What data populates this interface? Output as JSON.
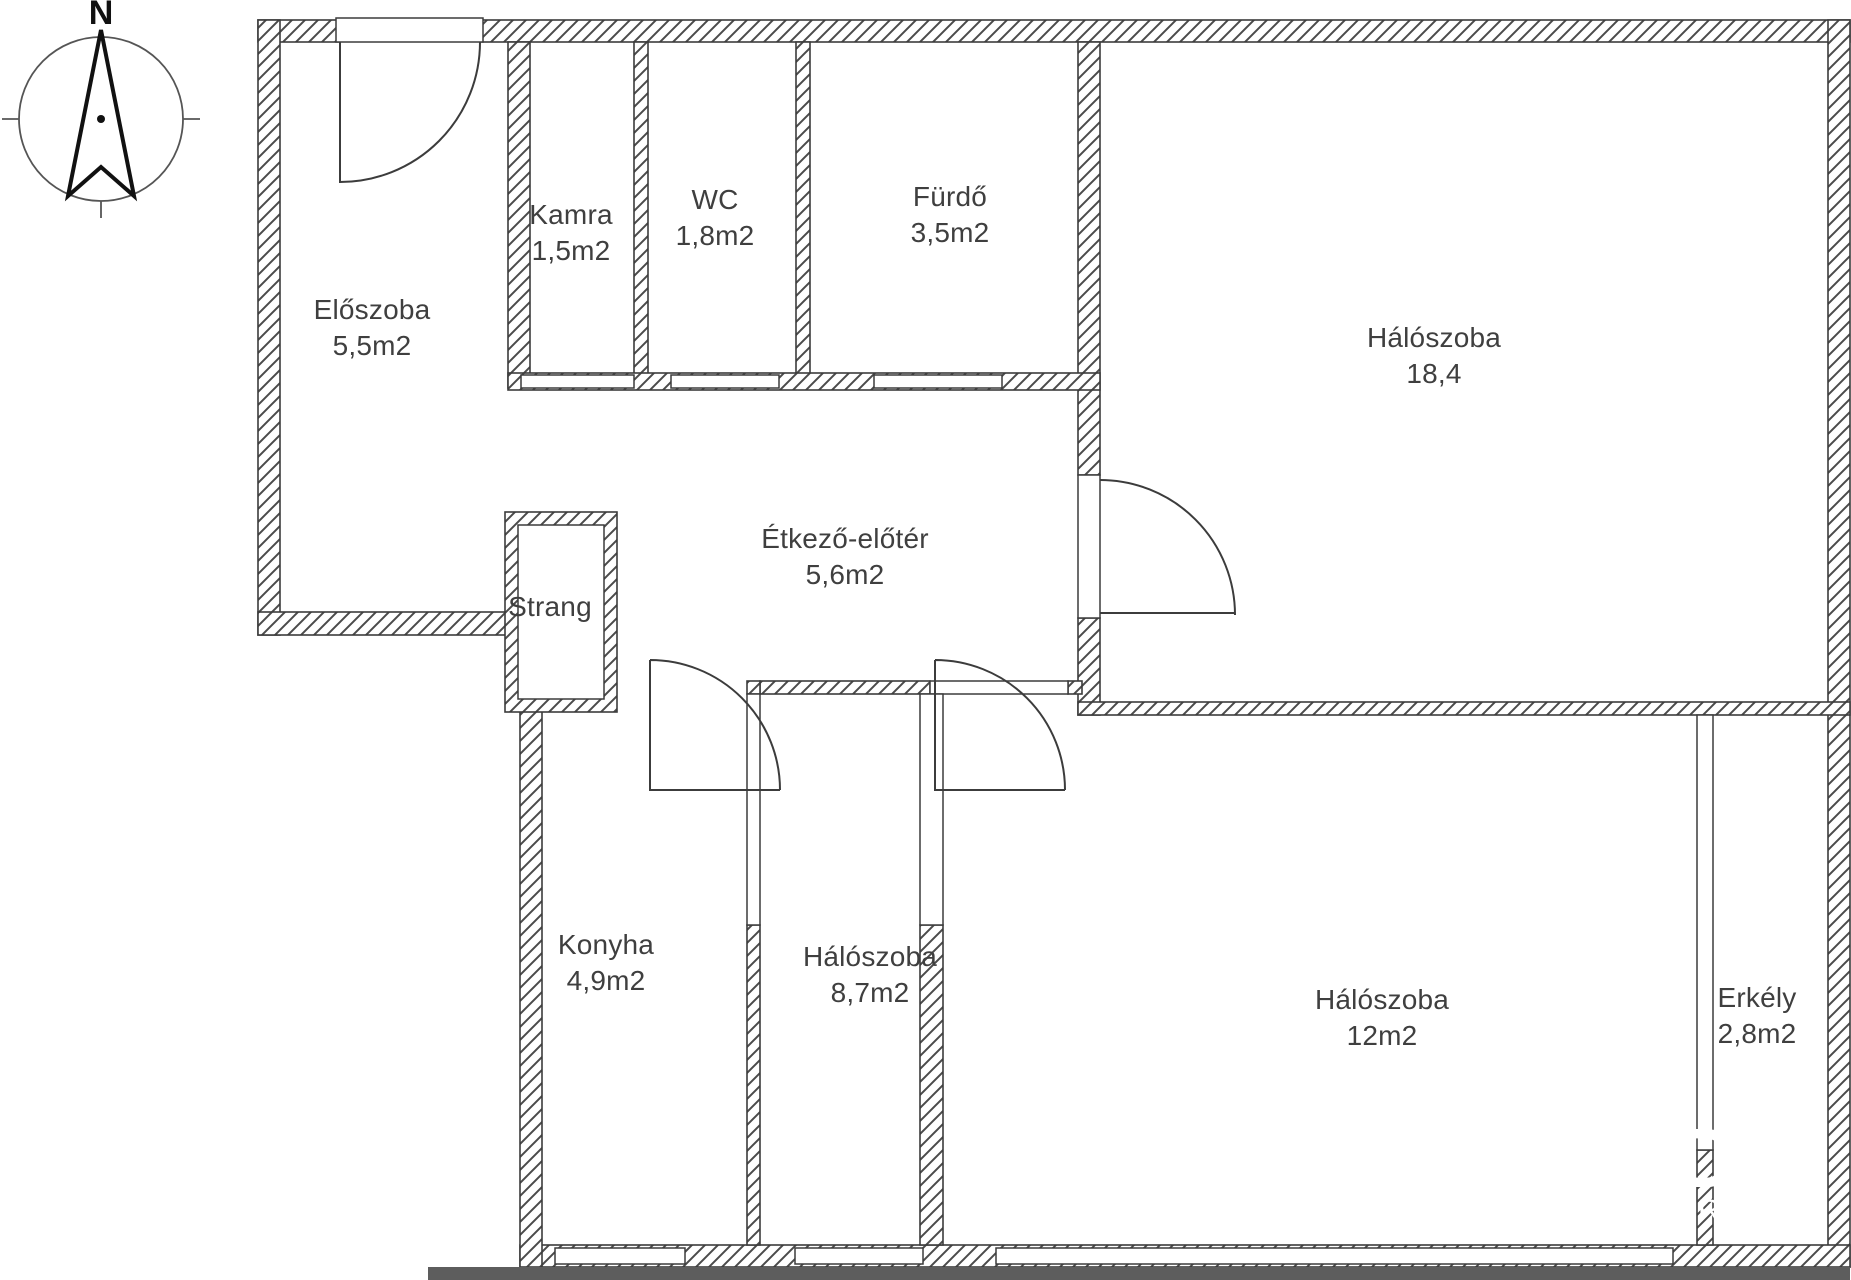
{
  "title": "Apartment floor plan",
  "compass": {
    "north_label": "N"
  },
  "rooms": [
    {
      "name": "Előszoba",
      "area": "5,5m2"
    },
    {
      "name": "Kamra",
      "area": "1,5m2"
    },
    {
      "name": "WC",
      "area": "1,8m2"
    },
    {
      "name": "Fürdő",
      "area": "3,5m2"
    },
    {
      "name": "Hálószoba",
      "area": "18,4"
    },
    {
      "name": "Étkező-előtér",
      "area": "5,6m2"
    },
    {
      "name": "Strang",
      "area": ""
    },
    {
      "name": "Konyha",
      "area": "4,9m2"
    },
    {
      "name": "Hálószoba",
      "area": "8,7m2"
    },
    {
      "name": "Hálószoba",
      "area": "12m2"
    },
    {
      "name": "Erkély",
      "area": "2,8m2"
    }
  ],
  "watermark": {
    "letter_large": "D",
    "letter_small": "R"
  },
  "colors": {
    "wall_line": "#3c3c3c",
    "hatch_line": "#4b4b4b",
    "label_text": "#3f3f3f",
    "watermark": "#ffffff",
    "cut_band": "#5d5d5d",
    "background": "#ffffff"
  }
}
